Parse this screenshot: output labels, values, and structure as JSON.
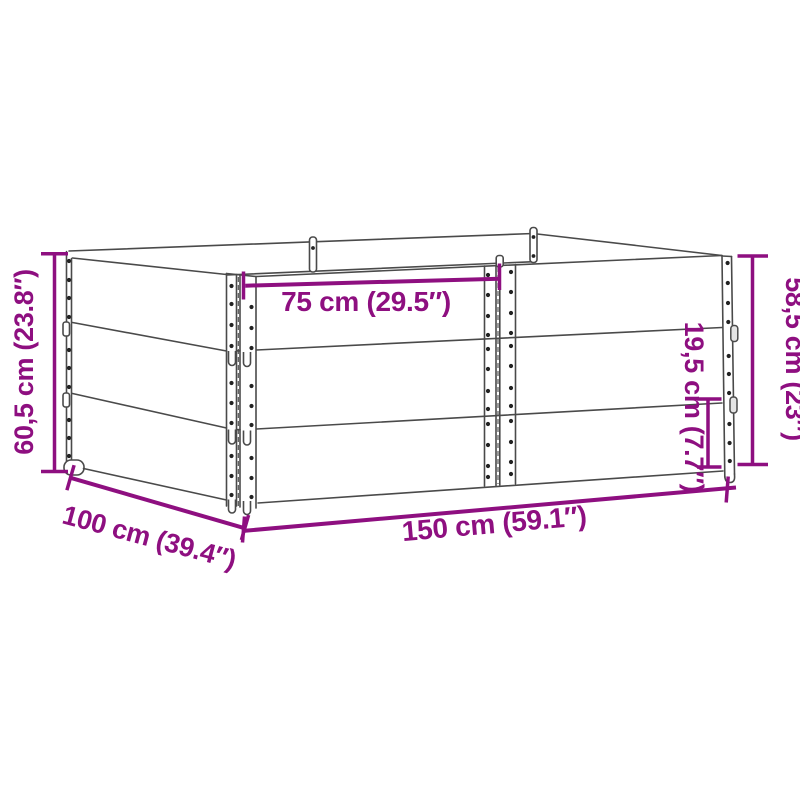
{
  "colors": {
    "dimension": "#8e0f80",
    "line": "#4a4a4a",
    "dot": "#222222",
    "bg": "#ffffff"
  },
  "diagram": {
    "labels": {
      "half_width_top": "75 cm (29.5″)",
      "total_height_left": "60,5 cm (23.8″)",
      "depth_bottom_left": "100 cm (39.4″)",
      "width_bottom": "150 cm (59.1″)",
      "collar_height_right": "19,5 cm (7.7″)",
      "stack_height_right": "58,5 cm (23″)"
    }
  }
}
